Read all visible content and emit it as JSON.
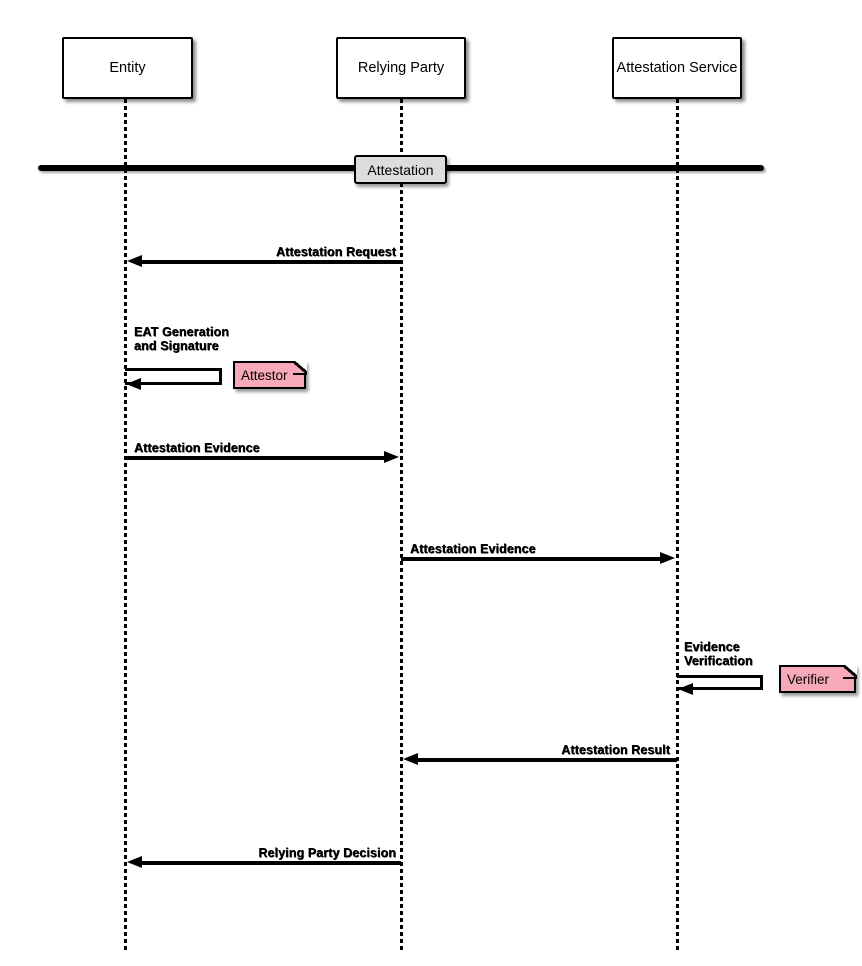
{
  "diagram_title": "Attestation sequence diagram",
  "participants": [
    {
      "label": "Entity"
    },
    {
      "label": "Relying Party"
    },
    {
      "label": "Attestation Service"
    }
  ],
  "divider": {
    "label": "Attestation"
  },
  "messages": {
    "attestation_request": {
      "label": "Attestation Request",
      "from": "Relying Party",
      "to": "Entity"
    },
    "eat_generation": {
      "line1": "EAT Generation",
      "line2": "and Signature",
      "on": "Entity"
    },
    "attestation_evidence_to_rp": {
      "label": "Attestation Evidence",
      "from": "Entity",
      "to": "Relying Party"
    },
    "attestation_evidence_to_as": {
      "label": "Attestation Evidence",
      "from": "Relying Party",
      "to": "Attestation Service"
    },
    "evidence_verification": {
      "line1": "Evidence",
      "line2": "Verification",
      "on": "Attestation Service"
    },
    "attestation_result": {
      "label": "Attestation Result",
      "from": "Attestation Service",
      "to": "Relying Party"
    },
    "relying_party_decision": {
      "label": "Relying Party Decision",
      "from": "Relying Party",
      "to": "Entity"
    }
  },
  "notes": {
    "attestor": {
      "label": "Attestor"
    },
    "verifier": {
      "label": "Verifier"
    }
  },
  "colors": {
    "line": "#000000",
    "participant_fill": "#FFFFFF",
    "divider_label_fill": "#DCDCDC",
    "note_fill": "#F7A9B9"
  }
}
